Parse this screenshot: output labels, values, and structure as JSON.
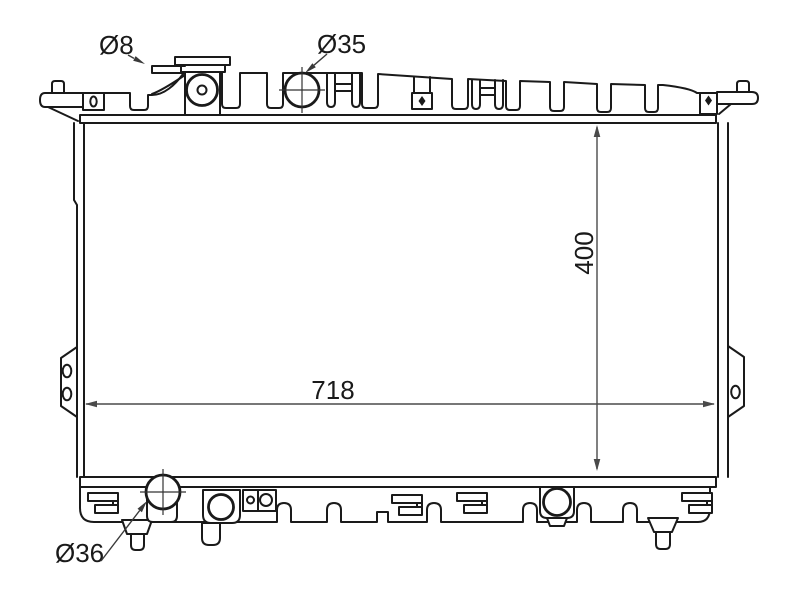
{
  "drawing": {
    "dimensions": {
      "overflow_port_diameter": "Ø8",
      "inlet_port_diameter": "Ø35",
      "outlet_port_diameter": "Ø36",
      "core_width": "718",
      "core_height": "400"
    },
    "colors": {
      "background": "#ffffff",
      "outline": "#1a1a1a",
      "dimension_line": "#4a4a4a",
      "label_text": "#1a1a1a"
    }
  }
}
